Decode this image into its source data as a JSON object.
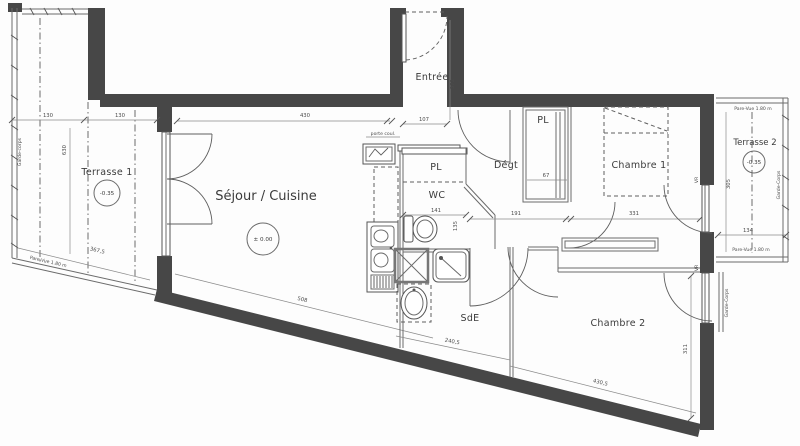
{
  "rooms": {
    "terrasse1": {
      "name": "Terrasse 1",
      "level": "-0.35"
    },
    "sejour": {
      "name": "Séjour / Cuisine",
      "level": "± 0.00"
    },
    "entree": {
      "name": "Entrée"
    },
    "pl_wc": {
      "name": "PL"
    },
    "wc": {
      "name": "WC"
    },
    "degt": {
      "name": "Dégt"
    },
    "pl_degt": {
      "name": "PL"
    },
    "chambre1": {
      "name": "Chambre 1"
    },
    "sde": {
      "name": "SdE"
    },
    "chambre2": {
      "name": "Chambre 2"
    },
    "terrasse2": {
      "name": "Terrasse 2",
      "level": "-0.35"
    }
  },
  "dims": {
    "t1_width_a": "130",
    "t1_width_b": "130",
    "t1_depth": "630",
    "t1_slope": "367,5",
    "sejour_width": "430",
    "sejour_slope": "508",
    "entree_width": "107",
    "entree_depth": "372",
    "wc_width": "141",
    "wc_depth": "135",
    "pl_width": "67",
    "degt_width": "191",
    "ch1_width": "331",
    "sde_slope": "240,5",
    "ch2_slope": "430,5",
    "ch2_depth": "311",
    "t2_width": "134",
    "t2_depth": "305"
  },
  "annotations": {
    "garde_corps": "Garde-corps",
    "garde_corps_caps": "Garde-Corps",
    "pare_vue": "Pare-Vue 1.80 m",
    "porte_coul": "porte coul.",
    "vr": "VR"
  }
}
